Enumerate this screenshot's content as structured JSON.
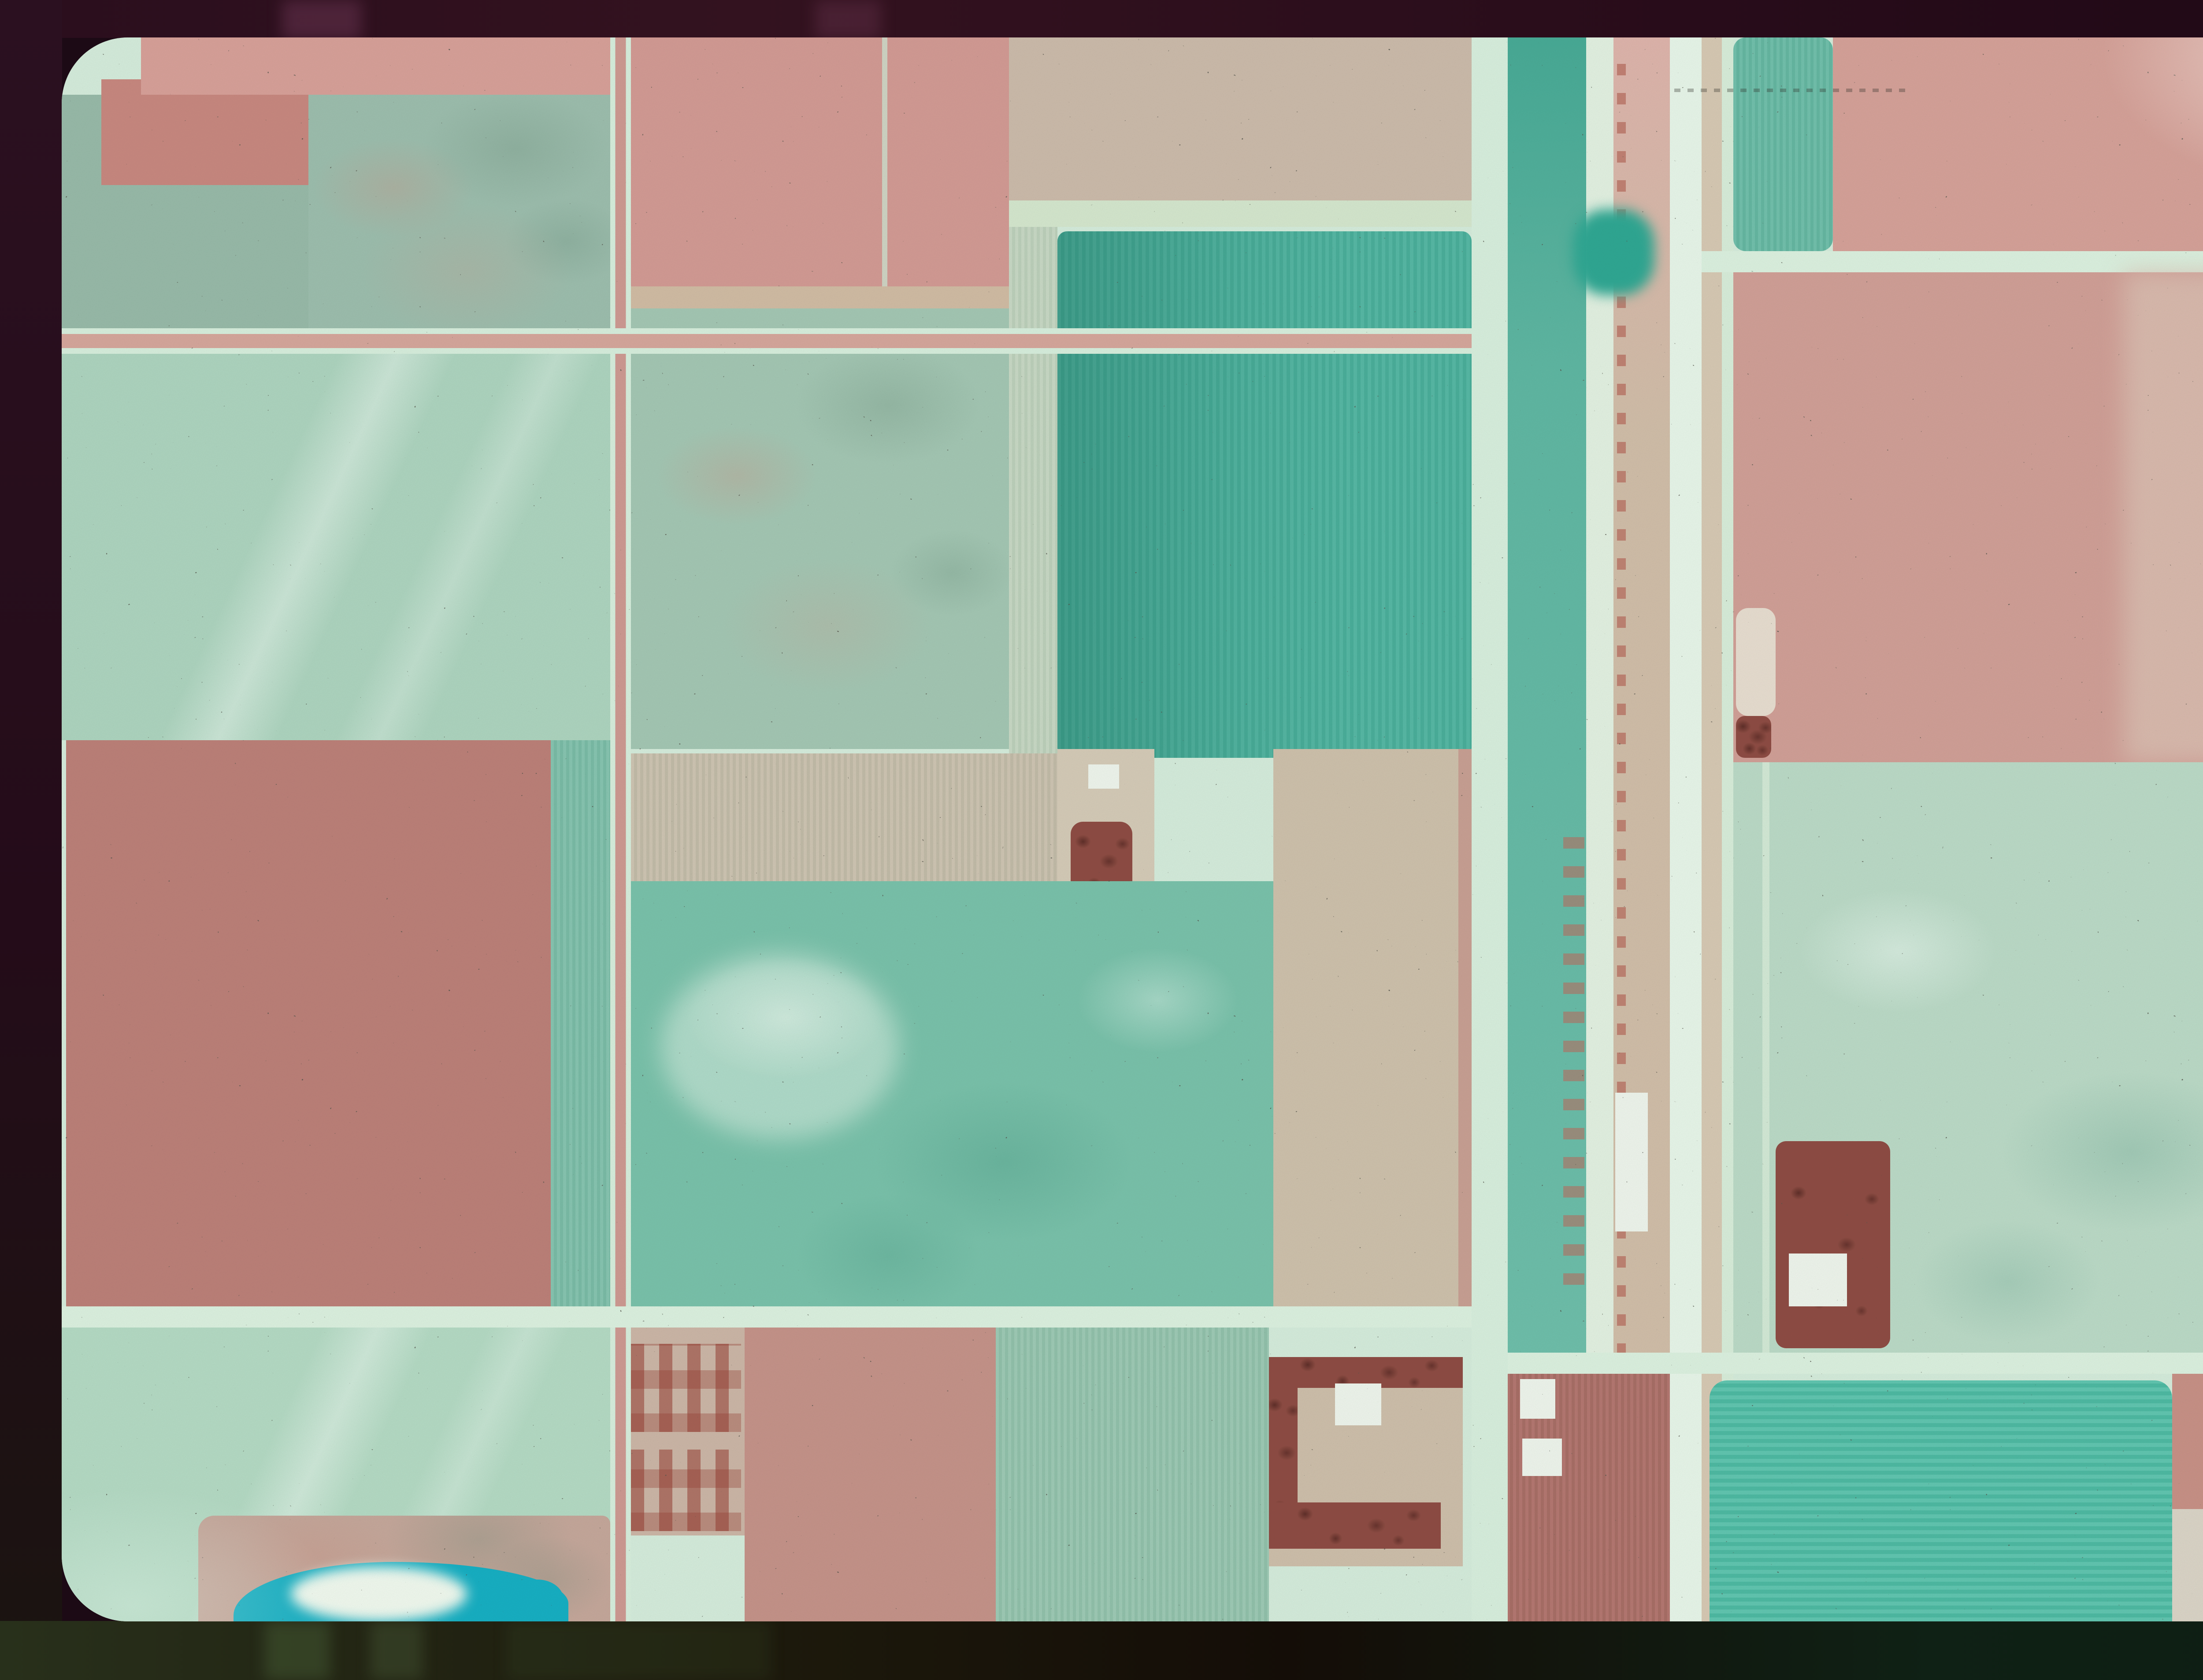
{
  "scene": {
    "kind": "false-color infrared aerial photograph mounted as a film slide",
    "content": "patchwork of rectangular farm fields, a north-south highway and railroad corridor, section-line roads, farmsteads with shelterbelt tree rows, and an alkaline pond wetland at lower left",
    "text_visible": "none"
  },
  "palette": {
    "photo_base": "#d6eedd",
    "road_mint": "#ddf3e1",
    "road_tan": "#d2bda4",
    "road_ne": "#d6e9cf",
    "highway_bright": "#e9f8eb",
    "corridor_mint": "#d9f1df",
    "corridor_teal": "#5eb8a3",
    "corridor_pale": "#e4f3e3",
    "corridor_tan": "#d2bfa9",
    "corridor_shoulder": "#d8cab4",
    "mint_line": "#d9efdb",
    "green_a": "#98bba9",
    "green_b": "#9dbfae",
    "pink_top_left": "#d9a199",
    "pink_deep": "#c9887f",
    "mint_big": "#aed6c0",
    "rose_big": "#bd8078",
    "teal_strip": "#7fc2ac",
    "green_bottom_left": "#b5dcc5",
    "wetland_tan": "#c6a89b",
    "pond_cyan": "#14b0c4",
    "cloud_white": "#f2fbf0",
    "pink_top_center": "#d49b94",
    "pink_field_line": "#cfe8d4",
    "buff_top": "#cdbcab",
    "pale_strip": "#c6d8c2",
    "teal_square": "#4cb5a0",
    "green_mottled": "#a4c8b4",
    "tan_strip": "#ccc2ae",
    "farm_buff": "#d6ccb8",
    "building_white": "#f0f7ee",
    "tree_red": "#8e4b42",
    "teal_big": "#79c3ab",
    "tan_band": "#cfc2ac",
    "pink_streak": "#c89a8e",
    "farm_parcel": "#cdb7a7",
    "pink_bottom_center": "#c69389",
    "green_bottom_center": "#98c8b1",
    "farm_tan": "#cfc0ab",
    "brown_field": "#b06f67",
    "junction_trees": "#2da893",
    "teal_top_east": "#68bda7",
    "pink_top_east": "#d7a299",
    "pale_corner": "#dceedd",
    "pink_big_east": "#d2a097",
    "pale_streak_east": "#dcc1b3",
    "pale_green_east": "#bcdcc8",
    "teal_bottom_east": "#52c2aa",
    "pink_bottom_east": "#c99186",
    "pale_bottom_right": "#dcd6c8",
    "pale_bottom_right2": "#d8d2c4",
    "farmstead_pale": "#e9dfd1",
    "border_top": "#2a0e1d",
    "border_right": "#160410",
    "border_bottom_left": "#28301b",
    "border_bottom_right": "#0f2115"
  }
}
